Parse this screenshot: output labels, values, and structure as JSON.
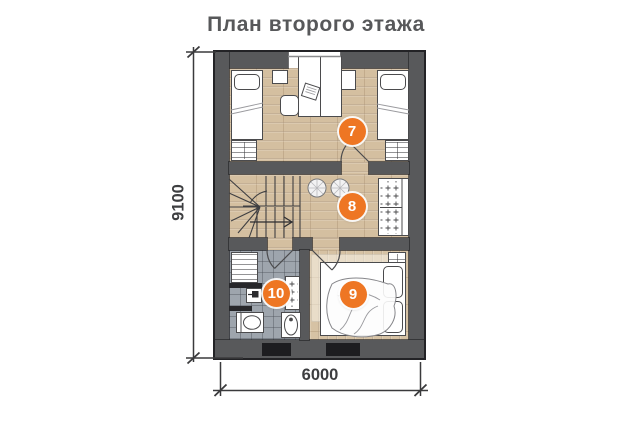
{
  "title": "План второго этажа",
  "dimension_labels": {
    "vertical": "9100",
    "horizontal": "6000"
  },
  "room_markers": [
    {
      "number": "7"
    },
    {
      "number": "8"
    },
    {
      "number": "9"
    },
    {
      "number": "10"
    }
  ],
  "colors": {
    "background": "#ffffff",
    "wall": "#58595b",
    "floor_wood": "#d4bfa0",
    "floor_tile": "#9ea5ad",
    "marker_accent": "#ee7623",
    "marker_text": "#ffffff",
    "line_art": "#4b4b4d",
    "text": "#57585a"
  },
  "plan_icons": [
    "single-bed-icon",
    "double-bed-icon",
    "pillow-icon",
    "desk-icon",
    "chair-icon",
    "laptop-icon",
    "nightstand-icon",
    "dresser-icon",
    "stairs-icon",
    "stair-arrow-icon",
    "pouf-icon",
    "wardrobe-icon",
    "shelf-icon",
    "washing-machine-icon",
    "toilet-icon",
    "washbasin-icon",
    "towel-radiator-icon",
    "door-arc-icon",
    "window-icon",
    "dimension-line-icon",
    "rug-icon"
  ]
}
